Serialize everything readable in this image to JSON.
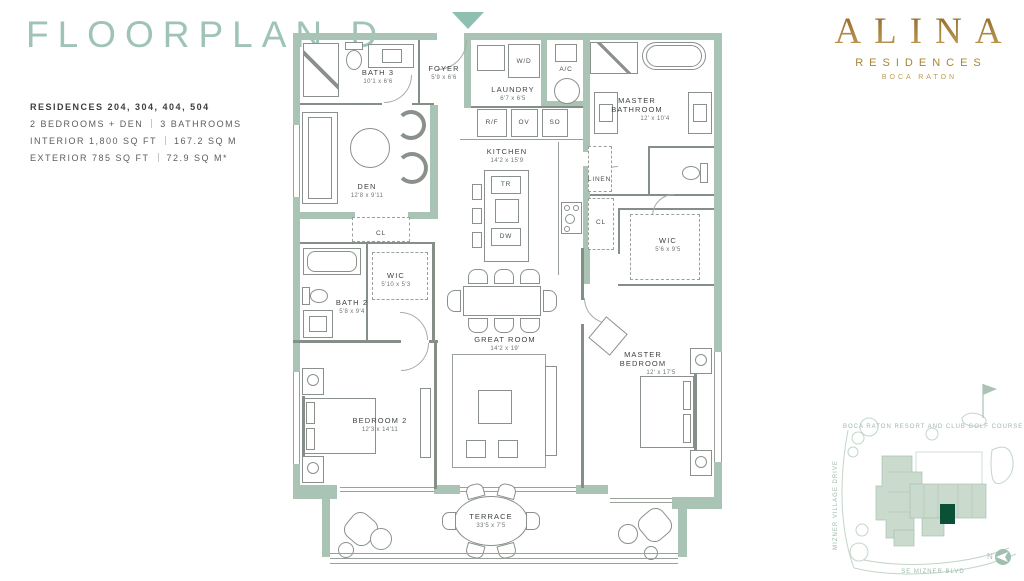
{
  "header": {
    "title": "FLOORPLAN D",
    "residences": "RESIDENCES 204, 304, 404, 504",
    "bedrooms": "2 BEDROOMS + DEN",
    "bathrooms": "3 BATHROOMS",
    "interior": "INTERIOR 1,800 SQ FT",
    "interior_m": "167.2 SQ M",
    "exterior": "EXTERIOR 785 SQ FT",
    "exterior_m": "72.9 SQ M*"
  },
  "brand": {
    "name": "ALINA",
    "tagline": "RESIDENCES",
    "location": "BOCA RATON"
  },
  "rooms": {
    "bath3": {
      "name": "BATH 3",
      "dims": "10'1 x 6'6"
    },
    "foyer": {
      "name": "FOYER",
      "dims": "5'9 x 6'6"
    },
    "laundry": {
      "name": "LAUNDRY",
      "dims": "6'7 x 6'5"
    },
    "master_bath": {
      "name": "MASTER BATHROOM",
      "dims": "12' x 10'4"
    },
    "kitchen": {
      "name": "KITCHEN",
      "dims": "14'2 x 15'9"
    },
    "den": {
      "name": "DEN",
      "dims": "12'8 x 9'11"
    },
    "wic2": {
      "name": "WIC",
      "dims": "5'10 x 5'3"
    },
    "bath2": {
      "name": "BATH 2",
      "dims": "5'8 x 9'4"
    },
    "wic_master": {
      "name": "WIC",
      "dims": "5'6 x 9'5"
    },
    "great_room": {
      "name": "GREAT ROOM",
      "dims": "14'2 x 19'"
    },
    "master_bedroom": {
      "name": "MASTER BEDROOM",
      "dims": "12' x 17'5"
    },
    "bedroom2": {
      "name": "BEDROOM 2",
      "dims": "12'3 x 14'11"
    },
    "terrace": {
      "name": "TERRACE",
      "dims": "33'5 x 7'5"
    }
  },
  "labels": {
    "wd": "W/D",
    "ac": "A/C",
    "rf": "R/F",
    "ov": "OV",
    "so": "SO",
    "tr": "TR",
    "dw": "DW",
    "cl_den": "CL",
    "cl_hall": "CL",
    "linen": "LINEN"
  },
  "map": {
    "golf_course": "BOCA RATON RESORT AND CLUB GOLF COURSE",
    "street_left": "MIZNER VILLAGE DRIVE",
    "street_bottom": "SE MIZNER BLVD",
    "north_label": "N"
  },
  "colors": {
    "wall": "#a9c3b4",
    "accent": "#9fc3b7",
    "gold": "#a98433",
    "map_line": "#c2d6c8",
    "unit_highlight": "#0b5137"
  }
}
